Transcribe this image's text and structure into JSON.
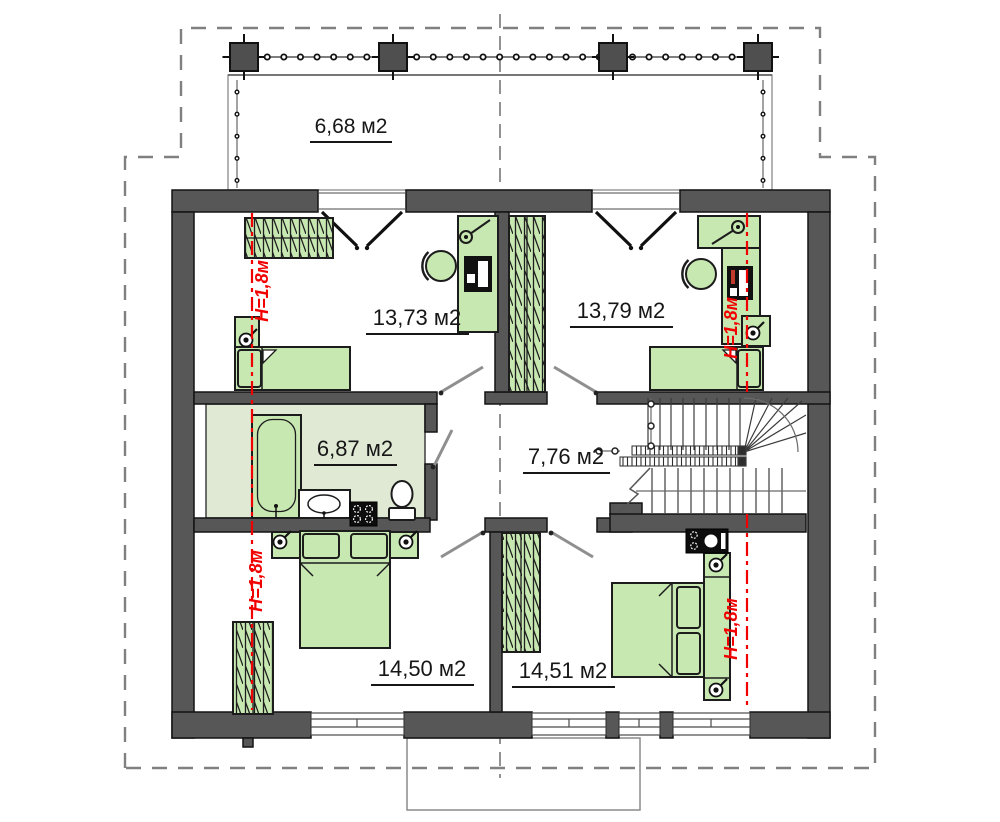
{
  "plan": {
    "balcony": {
      "area": "6,68 м2"
    },
    "bedroom_top_left": {
      "area": "13,73 м2"
    },
    "bedroom_top_right": {
      "area": "13,79 м2"
    },
    "bathroom": {
      "area": "6,87 м2"
    },
    "hall": {
      "area": "7,76 м2"
    },
    "bedroom_bottom_left": {
      "area": "14,50 м2"
    },
    "bedroom_bottom_right": {
      "area": "14,51 м2"
    },
    "height_marks": {
      "top_left": "Н=1,8м",
      "top_right": "Н=1,8м",
      "bottom_left": "Н=1,8м",
      "bottom_right": "Н=1,8м"
    },
    "colors": {
      "wall_fill": "#575757",
      "furniture_fill": "#c8e8b2",
      "bathroom_floor": "#dfe9d4",
      "height_mark_red": "#f10000",
      "roof_outline_gray": "#808080"
    }
  }
}
